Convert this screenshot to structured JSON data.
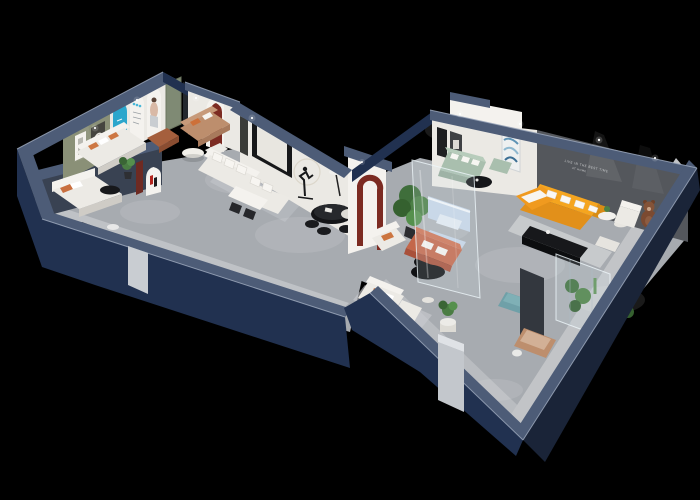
{
  "scene": {
    "wall_slogan": {
      "line1": "LIVE IN THE BEST TIME",
      "line2": "AT HOME"
    }
  },
  "colors": {
    "bg": "#000000",
    "wall_navy": "#213150",
    "wall_navy_dark": "#1a2438",
    "wall_cap": "#4d5c77",
    "edge_highlight": "#9aa6ba",
    "floor": "#a7abb0",
    "white_wall": "#ebe9e4",
    "green_wall": "#8a9077",
    "feature_wall": "#54575c",
    "cyan": "#2ba6cc",
    "maroon": "#7c2b22",
    "orange": "#f5a51f",
    "coral": "#c4674a",
    "sage": "#a9bfae",
    "pale_blue": "#c6d4e6",
    "teal": "#6fa0a8",
    "tan": "#bd8e6d",
    "leather": "#a55f3d",
    "plant": "#4a7c43",
    "black_furniture": "#141518",
    "glass": "#dcebf2"
  }
}
